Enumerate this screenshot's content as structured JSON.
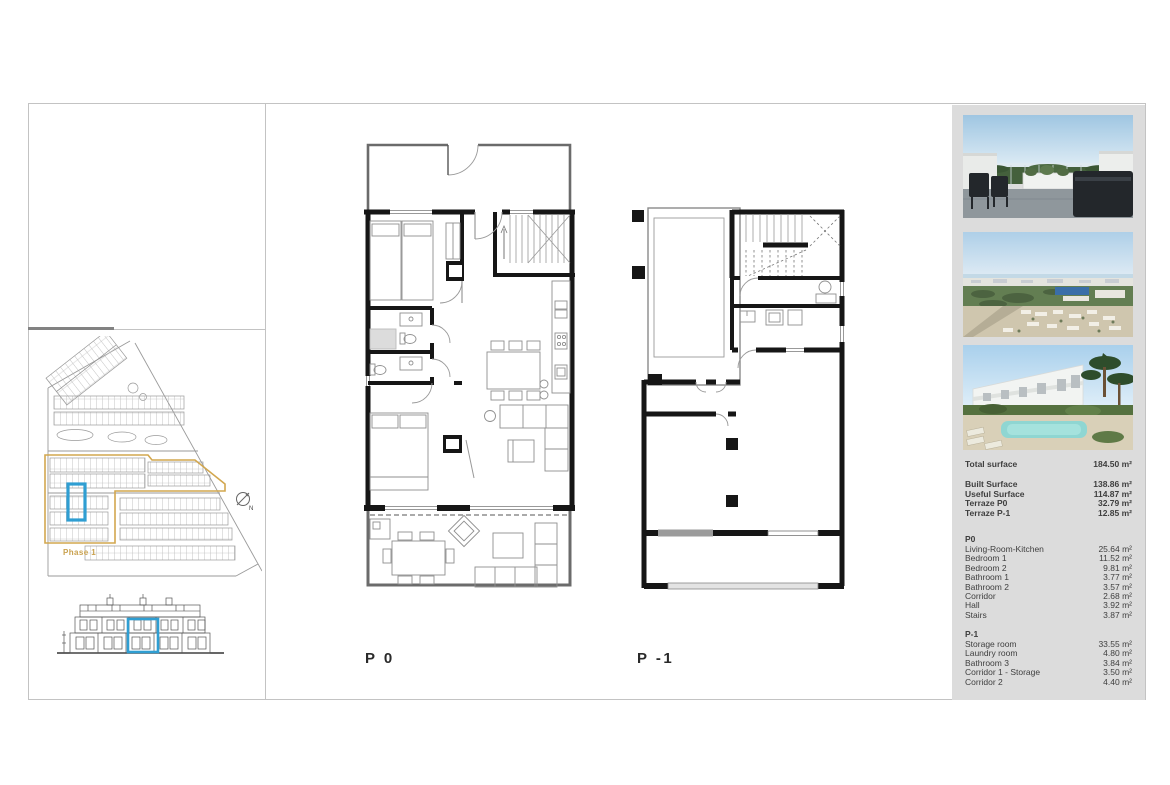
{
  "document": {
    "phase_label": "Phase 1",
    "compass_north": "N",
    "plan_labels": {
      "p0": "P 0",
      "p1": "P -1"
    }
  },
  "colors": {
    "highlight_blue": "#2f9ed2",
    "phase_yellow": "#d2a74f",
    "sidebar_bg": "#dcdcdc"
  },
  "sidebar": {
    "total": {
      "label": "Total surface",
      "value": "184.50 m²"
    },
    "overview": [
      {
        "label": "Built Surface",
        "value": "138.86 m²"
      },
      {
        "label": "Useful Surface",
        "value": "114.87 m²"
      },
      {
        "label": "Terraze P0",
        "value": "32.79 m²"
      },
      {
        "label": "Terraze P-1",
        "value": "12.85 m²"
      }
    ],
    "p0": {
      "title": "P0",
      "rows": [
        {
          "label": "Living-Room-Kitchen",
          "value": "25.64 m²"
        },
        {
          "label": "Bedroom 1",
          "value": "11.52 m²"
        },
        {
          "label": "Bedroom 2",
          "value": "9.81 m²"
        },
        {
          "label": "Bathroom 1",
          "value": "3.77 m²"
        },
        {
          "label": "Bathroom 2",
          "value": "3.57 m²"
        },
        {
          "label": "Corridor",
          "value": "2.68 m²"
        },
        {
          "label": "Hall",
          "value": "3.92 m²"
        },
        {
          "label": "Stairs",
          "value": "3.87 m²"
        }
      ]
    },
    "p1": {
      "title": "P-1",
      "rows": [
        {
          "label": "Storage room",
          "value": "33.55 m²"
        },
        {
          "label": "Laundry room",
          "value": "4.80 m²"
        },
        {
          "label": "Bathroom 3",
          "value": "3.84 m²"
        },
        {
          "label": "Corridor 1 - Storage",
          "value": "3.50 m²"
        },
        {
          "label": "Corridor 2",
          "value": "4.40 m²"
        }
      ]
    }
  }
}
